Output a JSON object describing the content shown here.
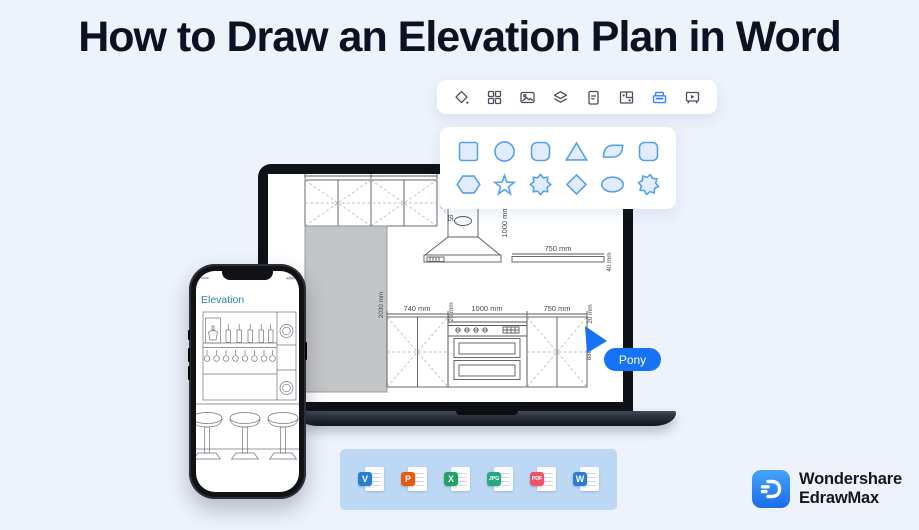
{
  "title": "How to Draw an Elevation Plan in Word",
  "toolbar": {
    "icons": [
      "fill-color",
      "components",
      "insert-image",
      "layers",
      "document",
      "floor-plan",
      "archive",
      "presentation"
    ],
    "active_index": 6,
    "active_color": "#3d7ffa",
    "icon_color": "#474e5d"
  },
  "shapes_panel": {
    "row1": [
      "square",
      "circle",
      "rounded-square",
      "triangle",
      "leaf",
      "rounded-square"
    ],
    "row2": [
      "hexagon",
      "star",
      "seal-star",
      "diamond",
      "ellipse",
      "seal-star"
    ],
    "stroke": "#55a0e8",
    "fill": "#e1edfc"
  },
  "plan": {
    "upper_cabinet_left": "840 mm",
    "upper_cabinet_right": "840 mm",
    "hood_duct": "55",
    "hood_height": "1000 mm",
    "shelf_width": "750 mm",
    "shelf_thickness": "40 mm",
    "wall_height": "2030mm",
    "base_wall_height": "2030 mm",
    "base_cabinet_left": "740 mm",
    "base_range": "1000 mm",
    "base_cabinet_right": "750 mm",
    "counter_left": "20 mm",
    "counter_right": "20 mm",
    "base_height": "880"
  },
  "phone": {
    "screen_title": "Elevation",
    "title_color": "#2d7fa6"
  },
  "cursor": {
    "label": "Pony",
    "color": "#1673f6"
  },
  "export_bar": {
    "formats": [
      {
        "label": "V",
        "color": "#2b7cd3"
      },
      {
        "label": "P",
        "color": "#e8590c"
      },
      {
        "label": "X",
        "color": "#21a366"
      },
      {
        "label": "JPG",
        "color": "#26a883"
      },
      {
        "label": "PDF",
        "color": "#ef5368"
      },
      {
        "label": "W",
        "color": "#2b7cd3"
      }
    ]
  },
  "brand": {
    "line1": "Wondershare",
    "line2": "EdrawMax",
    "accent": "#1b7df2"
  }
}
